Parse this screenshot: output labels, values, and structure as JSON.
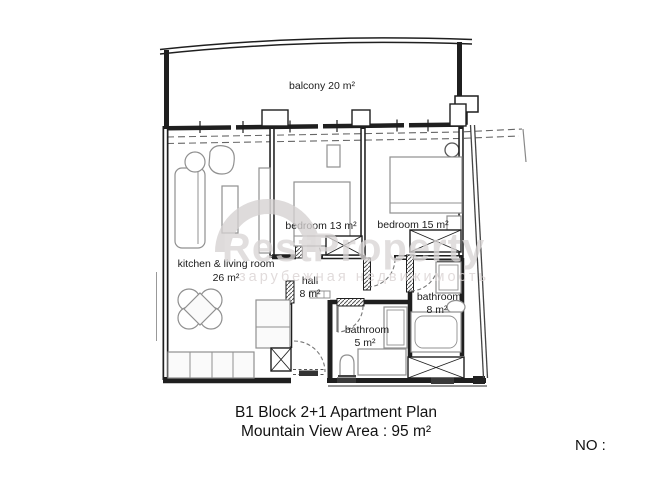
{
  "plan": {
    "balcony": {
      "label": "balcony 20 m²"
    },
    "kitchen_living": {
      "line1": "kitchen & living room",
      "line2": "26 m²"
    },
    "bedroom13": {
      "label": "bedroom 13 m²"
    },
    "bedroom15": {
      "label": "bedroom 15 m²"
    },
    "hall": {
      "line1": "hall",
      "line2": "8 m²"
    },
    "bathroom5": {
      "line1": "bathroom",
      "line2": "5 m²"
    },
    "bathroom8": {
      "line1": "bathroom",
      "line2": "8 m²"
    }
  },
  "caption": {
    "line1": "B1 Block 2+1 Apartment Plan",
    "line2": "Mountain View Area : 95 m²"
  },
  "number_field": {
    "label": "NO :"
  },
  "watermark": {
    "brand": "RestProperty",
    "tagline": "зарубежная недвижимость"
  },
  "colors": {
    "wall": "#1f1f1f",
    "furniture": "#909090",
    "watermark": "#d9d5d5",
    "text": "#121212"
  }
}
